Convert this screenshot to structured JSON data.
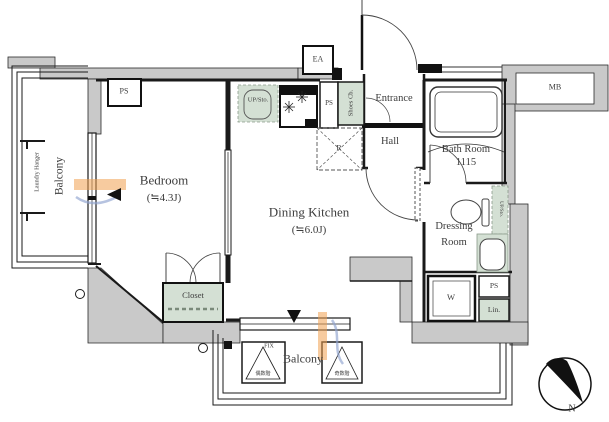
{
  "rooms": {
    "balcony_left": "Balcony",
    "laundry_hanger": "Laundry Hanger",
    "bedroom": {
      "name": "Bedroom",
      "size": "(≒4.3J)"
    },
    "dining_kitchen": {
      "name": "Dining Kitchen",
      "size": "(≒6.0J)"
    },
    "closet": "Closet",
    "entrance": "Entrance",
    "hall": "Hall",
    "bath_room": {
      "name": "Bath Room",
      "size": "1115"
    },
    "dressing_room": {
      "line1": "Dressing",
      "line2": "Room"
    },
    "balcony_bottom": "Balcony"
  },
  "labels": {
    "ps_top": "PS",
    "ps_kitchen": "PS",
    "ps_lower": "PS",
    "ea": "EA",
    "mb": "MB",
    "up_sto_kitchen": "UP/Sto.",
    "up_sto_dressing": "UP/Sto.",
    "shoes_cabinet": "Shoes Cb.",
    "refrigerator": "R",
    "washer": "W",
    "linen": "Lin.",
    "fix_window": "FIX",
    "hatch_even_floors": "偶数階",
    "hatch_odd_floors": "奇数階",
    "compass_north": "N"
  },
  "colors": {
    "wall_fill": "#c9c9c9",
    "storage_fill": "#d4e0d4",
    "line": "#1a1a1a",
    "watermark_orange": "#f0a050",
    "watermark_blue": "#8fa3cf"
  }
}
